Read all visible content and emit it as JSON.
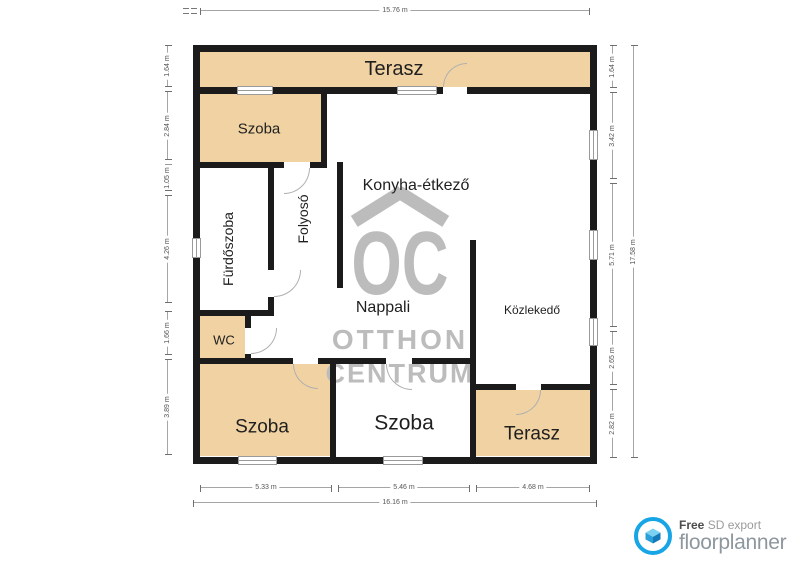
{
  "plan": {
    "rooms": [
      {
        "name": "terasz-top",
        "label": "Terasz"
      },
      {
        "name": "szoba-top-left",
        "label": "Szoba"
      },
      {
        "name": "konyha-etkezo",
        "label": "Konyha-étkező"
      },
      {
        "name": "furdoszoba",
        "label": "Fürdőszoba"
      },
      {
        "name": "folyoso",
        "label": "Folyosó"
      },
      {
        "name": "nappali",
        "label": "Nappali"
      },
      {
        "name": "wc",
        "label": "WC"
      },
      {
        "name": "kozlekedo",
        "label": "Közlekedő"
      },
      {
        "name": "szoba-bottom-left",
        "label": "Szoba"
      },
      {
        "name": "szoba-bottom-mid",
        "label": "Szoba"
      },
      {
        "name": "terasz-bottom",
        "label": "Terasz"
      }
    ]
  },
  "dimensions": {
    "top_total": "15.76 m",
    "bottom_segments": [
      "5.33 m",
      "5.46 m",
      "4.68 m"
    ],
    "bottom_total": "16.16 m",
    "left_segments": [
      "1.64 m",
      "2.84 m",
      "1.05 m",
      "4.26 m",
      "1.66 m",
      "3.89 m"
    ],
    "right_segments": [
      "1.64 m",
      "3.42 m",
      "5.71 m",
      "2.65 m",
      "2.82 m"
    ],
    "right_total": "17.58 m"
  },
  "watermark": {
    "monogram": "OC",
    "line1": "OTTHON",
    "line2": "CENTRUM"
  },
  "branding": {
    "free_label": "Free",
    "export_label": "SD export",
    "brand_name": "floorplanner"
  },
  "colors": {
    "wall": "#1b1b1b",
    "floor_tan": "#f1d3a3",
    "floor_white": "#ffffff",
    "watermark_gray": "#bcbcbc",
    "brand_blue": "#18a5e6"
  }
}
